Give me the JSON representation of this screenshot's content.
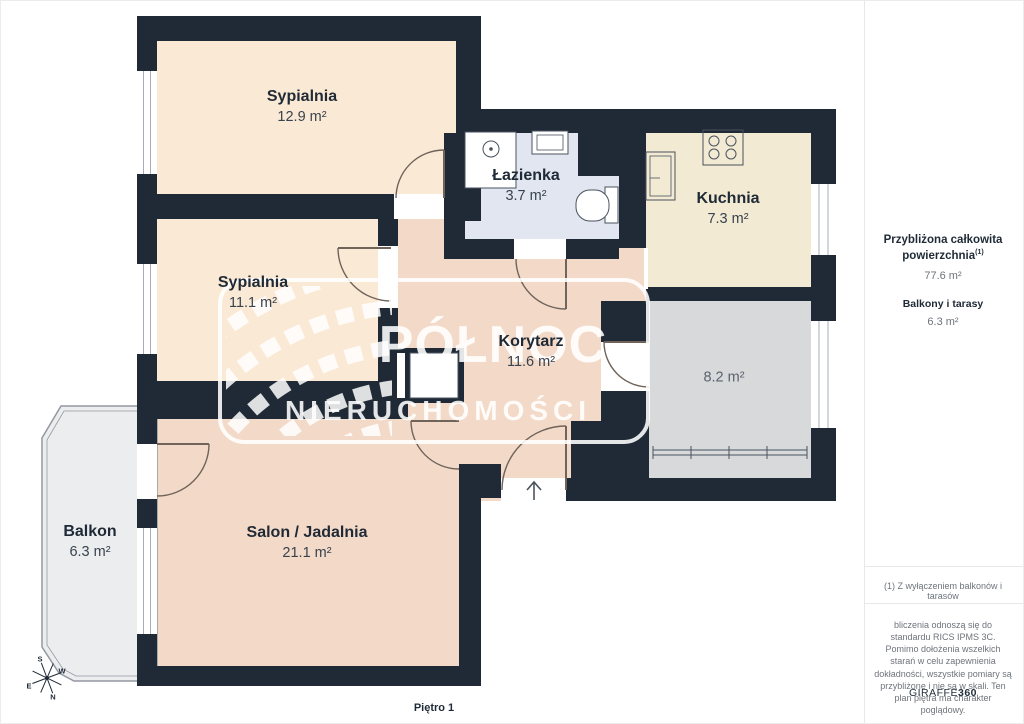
{
  "floorplan": {
    "floor_label": "Piętro 1",
    "rooms": [
      {
        "id": "sypialnia-1",
        "name": "Sypialnia",
        "area": "12.9 m²"
      },
      {
        "id": "sypialnia-2",
        "name": "Sypialnia",
        "area": "11.1 m²"
      },
      {
        "id": "lazienka",
        "name": "Łazienka",
        "area": "3.7 m²"
      },
      {
        "id": "kuchnia",
        "name": "Kuchnia",
        "area": "7.3 m²"
      },
      {
        "id": "korytarz",
        "name": "Korytarz",
        "area": "11.6 m²"
      },
      {
        "id": "pomieszczenie",
        "name": "",
        "area": "8.2 m²"
      },
      {
        "id": "salon-jadalnia",
        "name": "Salon / Jadalnia",
        "area": "21.1 m²"
      },
      {
        "id": "balkon",
        "name": "Balkon",
        "area": "6.3 m²"
      }
    ],
    "compass": {
      "north": "N",
      "south": "S",
      "east": "E",
      "west": "W"
    },
    "watermark": {
      "line1": "PÓŁNOC",
      "line2": "NIERUCHOMOŚCI"
    }
  },
  "sidebar": {
    "total_area_label": "Przybliżona całkowita powierzchnia",
    "total_area_footnote_marker": "(1)",
    "total_area_value": "77.6 m²",
    "balconies_label": "Balkony i tarasy",
    "balconies_value": "6.3 m²",
    "footnote": "(1) Z wyłączeniem balkonów i tarasów",
    "disclaimer": "bliczenia odnoszą się do standardu RICS IPMS 3C. Pomimo dołożenia wszelkich starań w celu zapewnienia dokładności, wszystkie pomiary są przybliżone i nie są w skali. Ten plan piętra ma charakter poglądowy.",
    "brand": "GIRAFFE",
    "brand_suffix": "360"
  },
  "colors": {
    "wall": "#1F2A36",
    "bedroom_fill": "#FAE9D4",
    "living_fill": "#F3D9C7",
    "kitchen_fill": "#F2EAD3",
    "bathroom_fill": "#E2E6F0",
    "unheated_room_fill": "#D8D9DB",
    "balcony_fill": "#ECEDEF"
  }
}
